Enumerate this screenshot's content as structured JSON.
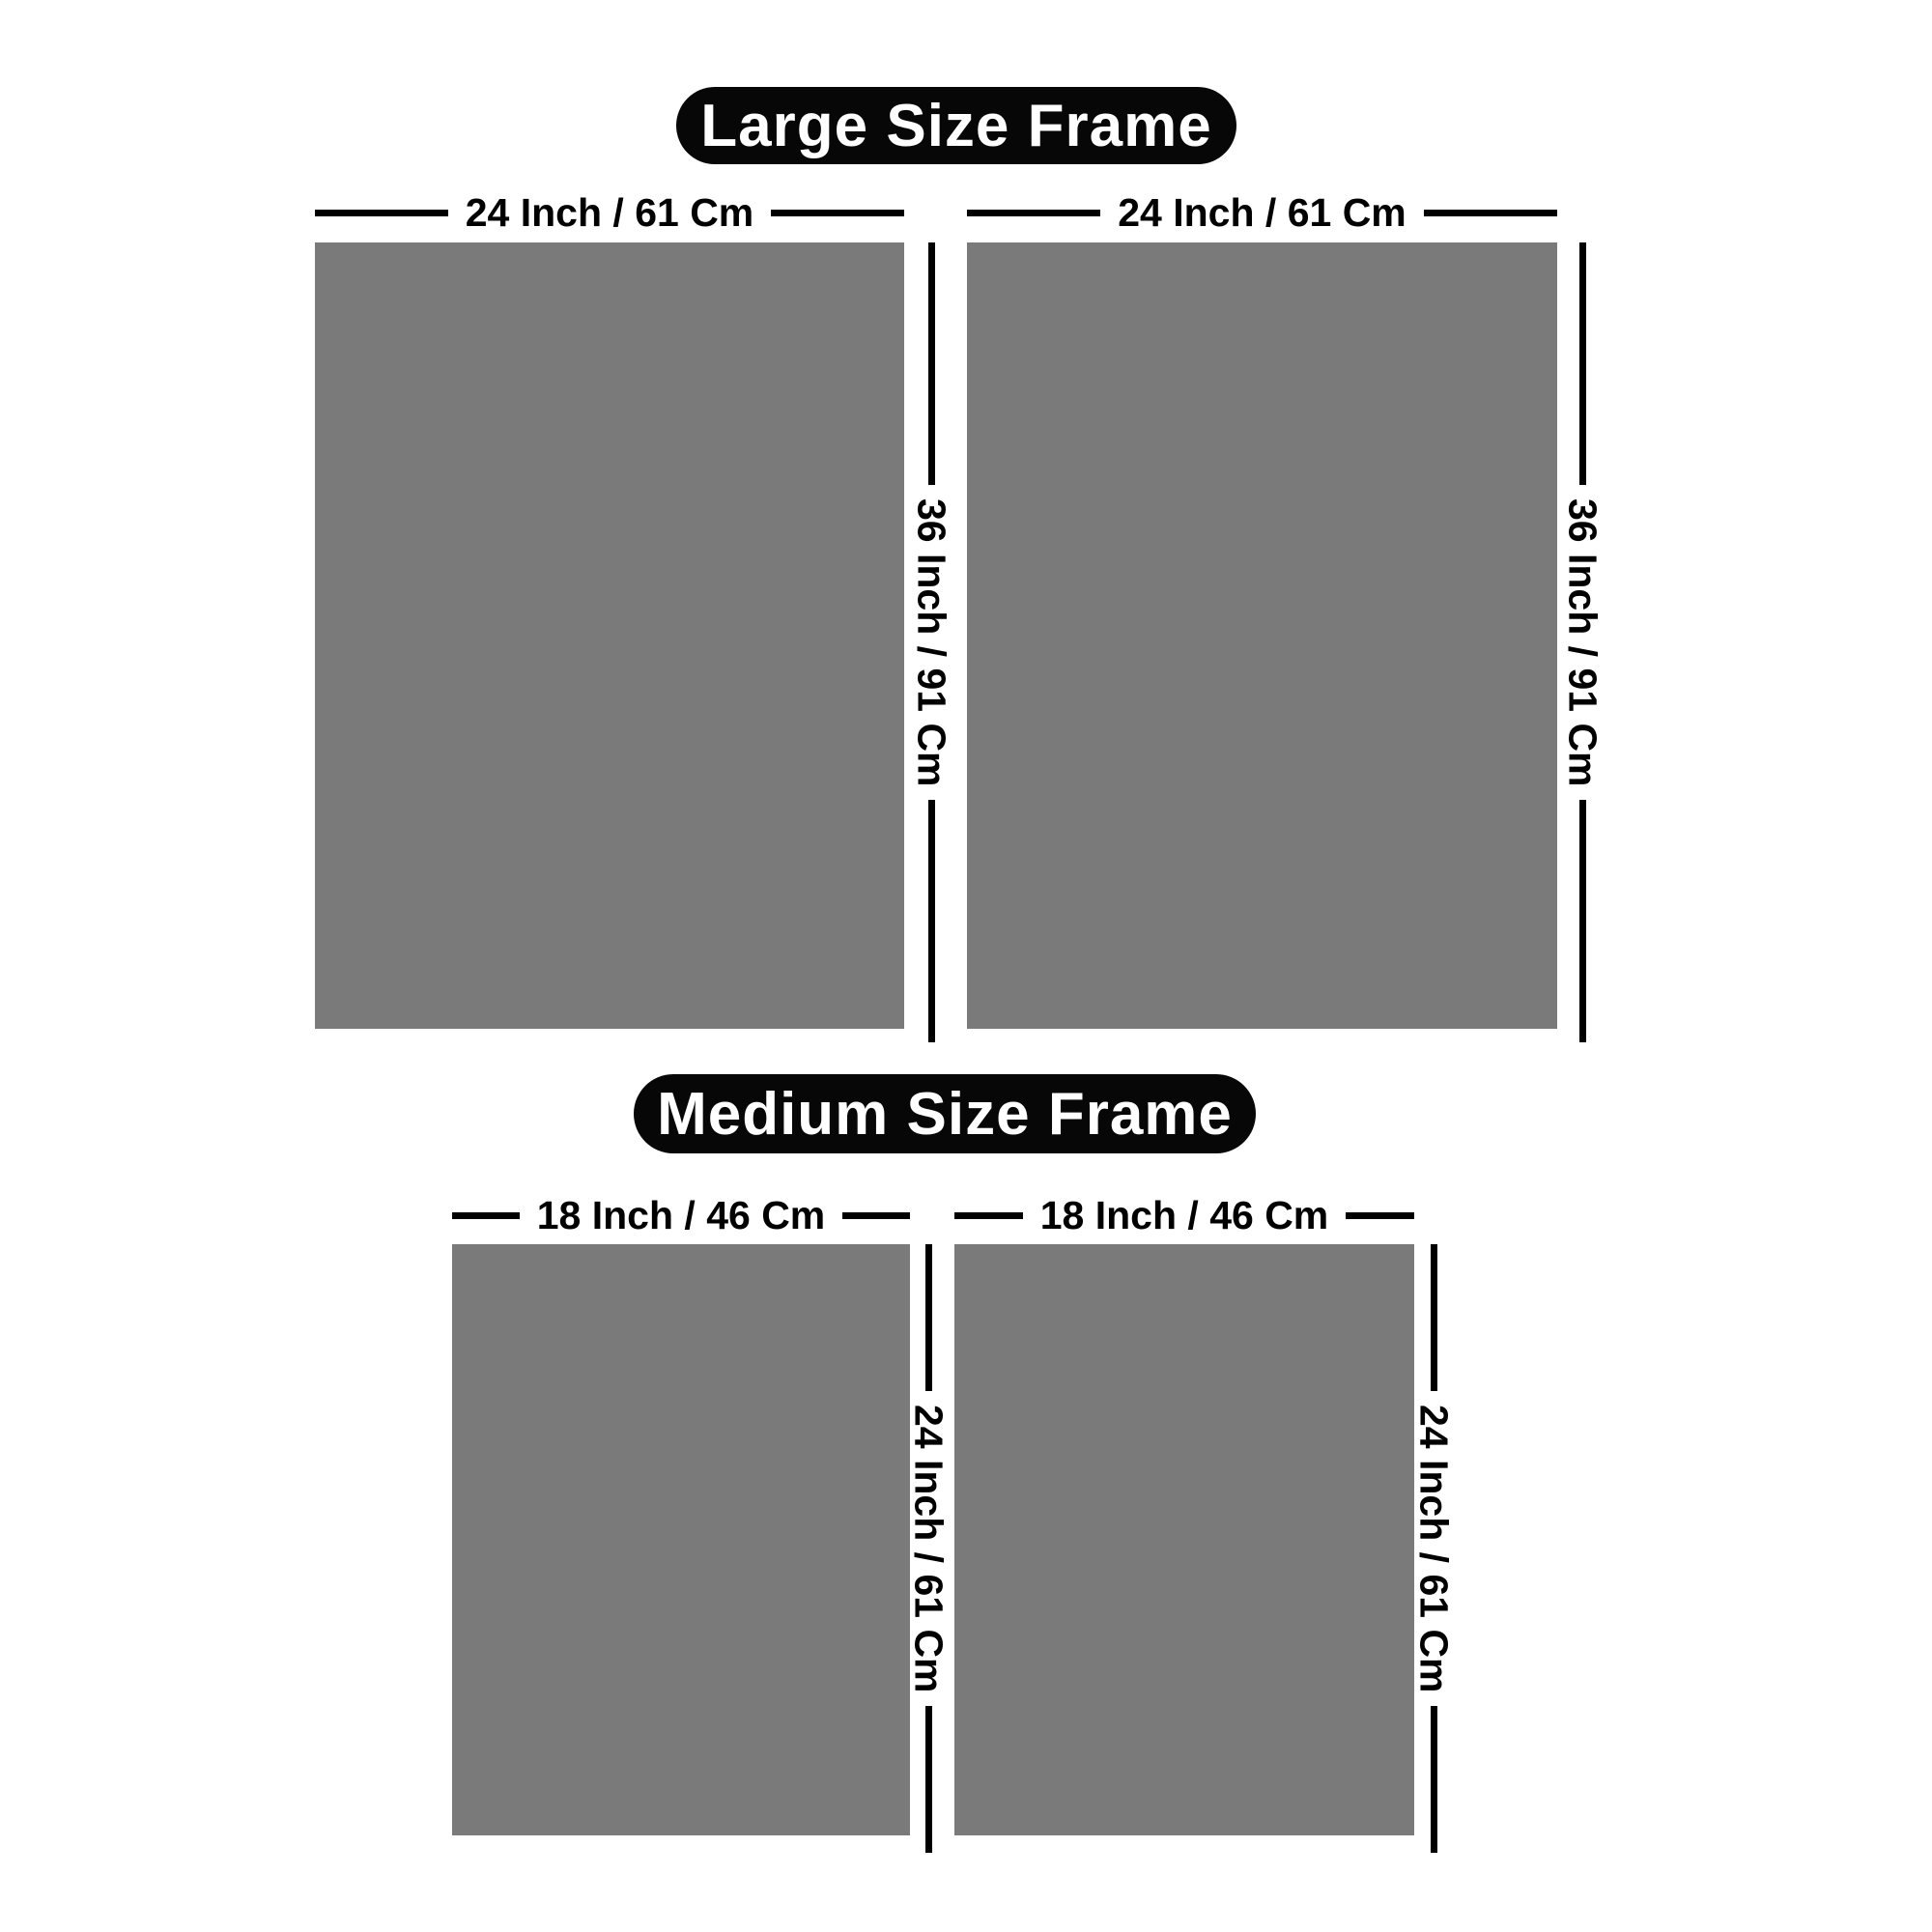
{
  "colors": {
    "background": "#ffffff",
    "frame_fill": "#7a7a7a",
    "dimension_line": "#000000",
    "badge_background": "#070707",
    "badge_text": "#ffffff"
  },
  "sections": [
    {
      "title": "Large Size Frame",
      "frames": [
        {
          "width_label": "24 Inch / 61 Cm",
          "height_label": "36 Inch / 91 Cm"
        },
        {
          "width_label": "24 Inch / 61 Cm",
          "height_label": "36 Inch / 91 Cm"
        }
      ]
    },
    {
      "title": "Medium Size Frame",
      "frames": [
        {
          "width_label": "18 Inch / 46 Cm",
          "height_label": "24 Inch / 61 Cm"
        },
        {
          "width_label": "18 Inch / 46 Cm",
          "height_label": "24 Inch / 61 Cm"
        }
      ]
    }
  ]
}
